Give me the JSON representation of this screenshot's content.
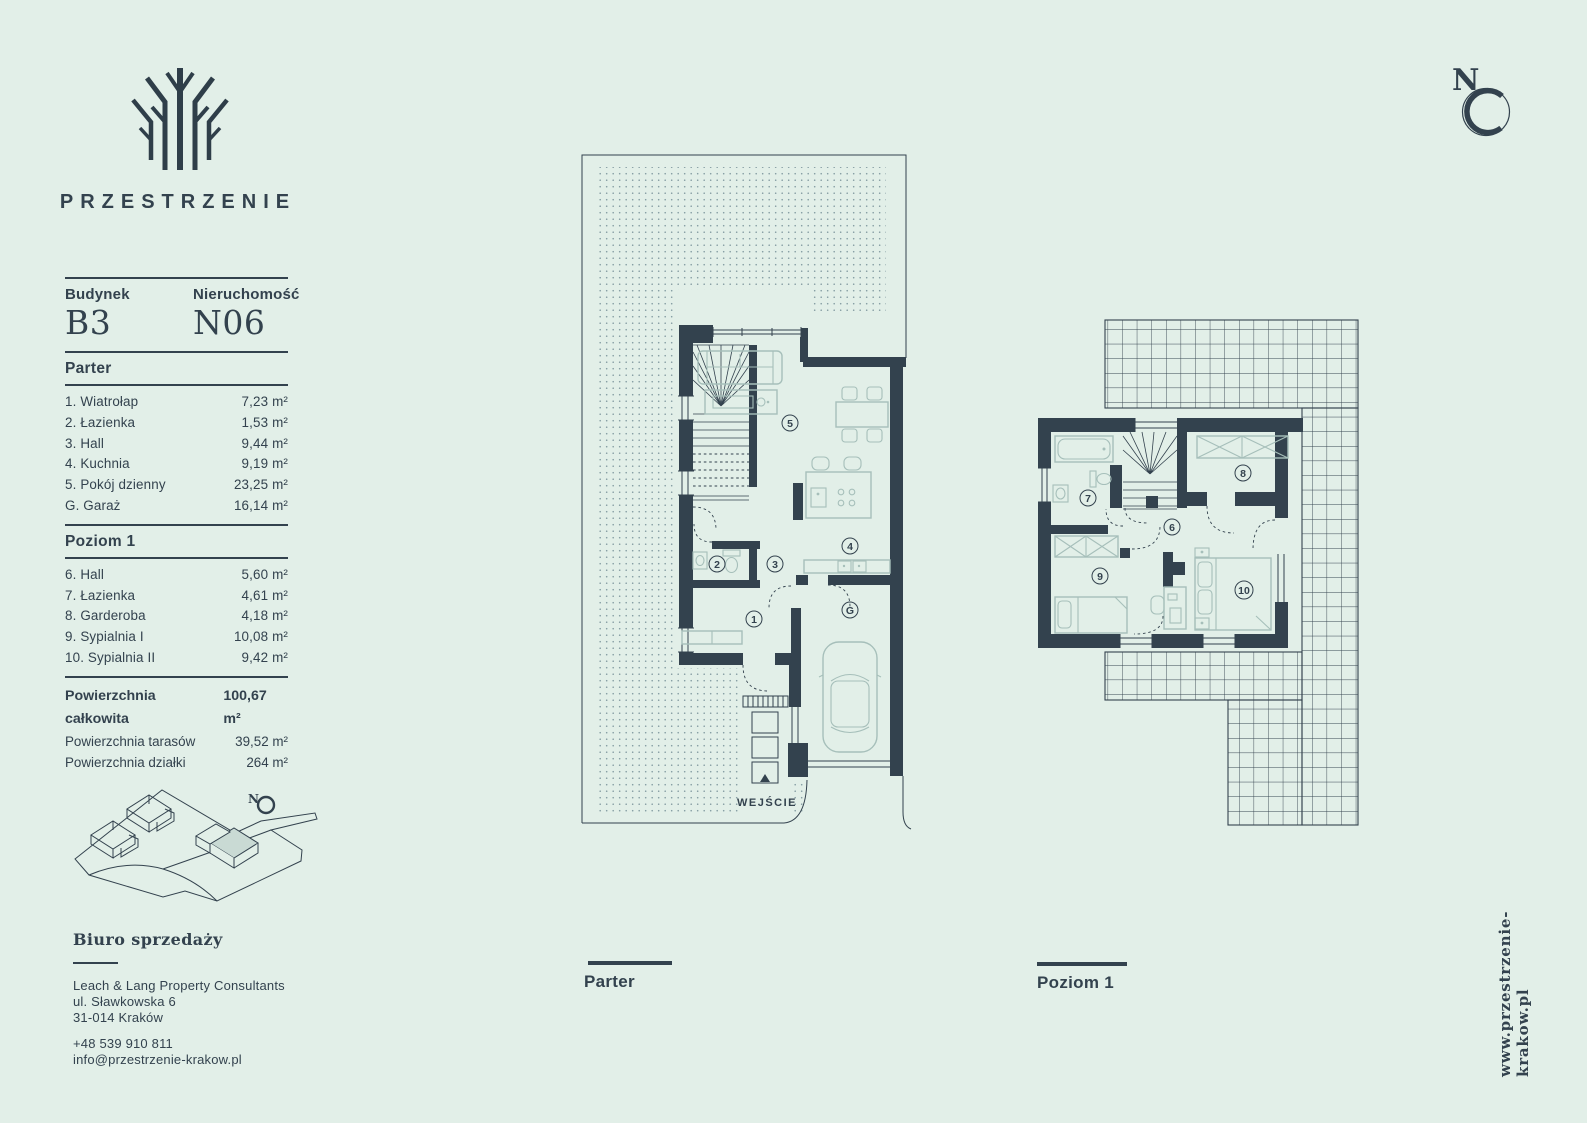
{
  "brand": {
    "name": "PRZESTRZENIE"
  },
  "compass": {
    "label": "N"
  },
  "unit": {
    "building_label": "Budynek",
    "building_value": "B3",
    "property_label": "Nieruchomość",
    "property_value": "N06"
  },
  "floors": [
    {
      "name": "Parter",
      "rooms": [
        {
          "label": "1. Wiatrołap",
          "area": "7,23 m²"
        },
        {
          "label": "2. Łazienka",
          "area": "1,53 m²"
        },
        {
          "label": "3. Hall",
          "area": "9,44 m²"
        },
        {
          "label": "4. Kuchnia",
          "area": "9,19 m²"
        },
        {
          "label": "5. Pokój dzienny",
          "area": "23,25 m²"
        },
        {
          "label": "G. Garaż",
          "area": "16,14 m²"
        }
      ]
    },
    {
      "name": "Poziom 1",
      "rooms": [
        {
          "label": "6. Hall",
          "area": "5,60 m²"
        },
        {
          "label": "7. Łazienka",
          "area": "4,61 m²"
        },
        {
          "label": "8. Garderoba",
          "area": "4,18 m²"
        },
        {
          "label": "9. Sypialnia I",
          "area": "10,08 m²"
        },
        {
          "label": "10. Sypialnia II",
          "area": "9,42 m²"
        }
      ]
    }
  ],
  "totals": [
    {
      "label": "Powierzchnia całkowita",
      "value": "100,67 m²"
    },
    {
      "label": "Powierzchnia tarasów",
      "value": "39,52 m²"
    },
    {
      "label": "Powierzchnia działki",
      "value": "264 m²"
    }
  ],
  "office": {
    "title": "Biuro sprzedaży",
    "company": "Leach & Lang Property Consultants",
    "street": "ul. Sławkowska 6",
    "city": "31-014 Kraków",
    "phone": "+48 539 910 811",
    "email": "info@przestrzenie-krakow.pl"
  },
  "plans": {
    "parter": {
      "caption": "Parter",
      "entrance": "WEJŚCIE",
      "numbers": [
        "1",
        "2",
        "3",
        "4",
        "5",
        "G"
      ]
    },
    "poziom": {
      "caption": "Poziom 1",
      "numbers": [
        "6",
        "7",
        "8",
        "9",
        "10"
      ]
    }
  },
  "website": "www.przestrzenie-krakow.pl",
  "colors": {
    "background": "#e2efe8",
    "ink": "#33424e",
    "furniture": "#a6bfba"
  }
}
